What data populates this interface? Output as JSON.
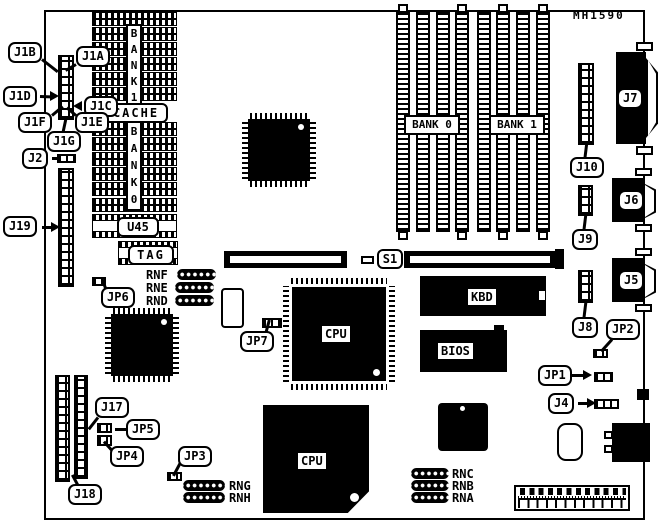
{
  "board_code": "MH1590",
  "callouts": {
    "j1b": "J1B",
    "j1a": "J1A",
    "j1d": "J1D",
    "j1c": "J1C",
    "j1f": "J1F",
    "j1e": "J1E",
    "j1g": "J1G",
    "j2": "J2",
    "j19": "J19",
    "jp6": "JP6",
    "jp7": "JP7",
    "j17": "J17",
    "jp5": "JP5",
    "jp4": "JP4",
    "jp3": "JP3",
    "j18": "J18",
    "j10": "J10",
    "j9": "J9",
    "j8": "J8",
    "jp2": "JP2",
    "jp1": "JP1",
    "j4": "J4"
  },
  "connector_labels": {
    "j7": "J7",
    "j6": "J6",
    "j5": "J5"
  },
  "chip_labels": {
    "cpu_main": "CPU",
    "cpu_secondary": "CPU",
    "kbd": "KBD",
    "bios": "BIOS",
    "cache": "CACHE",
    "tag": "TAG",
    "u45": "U45",
    "s1": "S1",
    "bank0_simm": "BANK 0",
    "bank1_simm": "BANK 1",
    "bank1_cache": "BANK1",
    "bank0_cache": "BANK0"
  },
  "resistor_networks": {
    "rnf": "RNF",
    "rne": "RNE",
    "rnd": "RND",
    "rng": "RNG",
    "rnh": "RNH",
    "rnc": "RNC",
    "rnb": "RNB",
    "rna": "RNA"
  },
  "colors": {
    "ink": "#000000",
    "paper": "#ffffff"
  }
}
